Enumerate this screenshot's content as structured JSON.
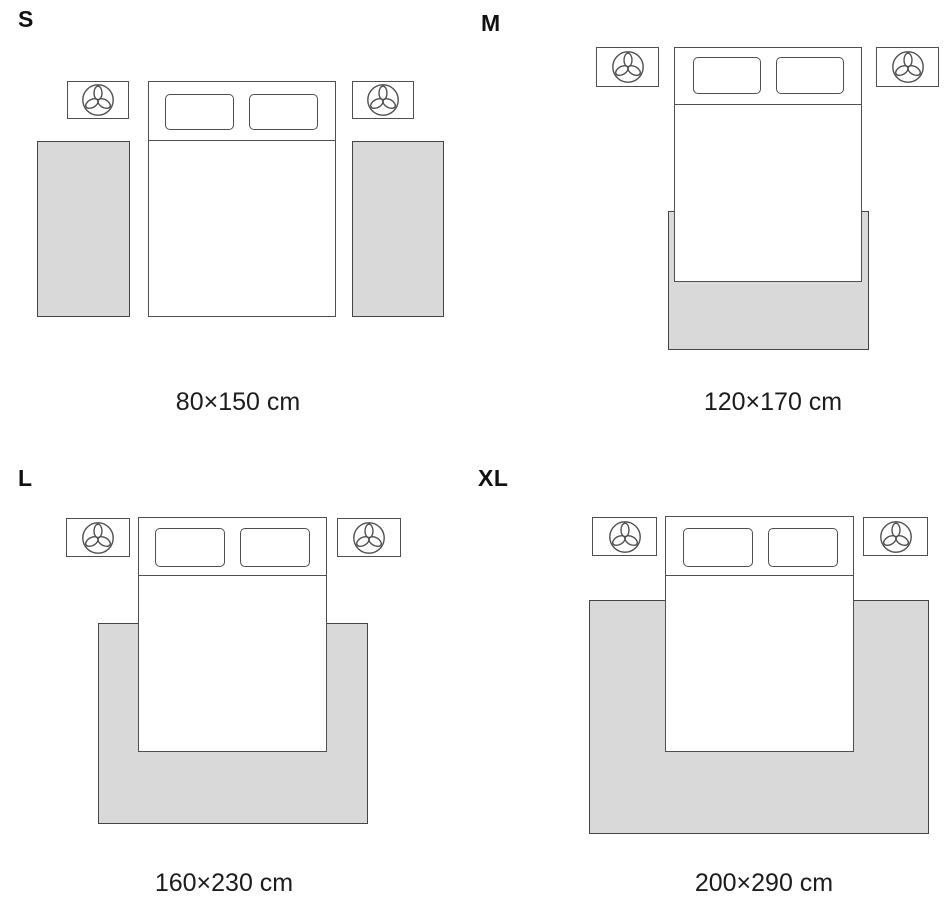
{
  "diagram_title": "",
  "colors": {
    "line": "#4f4f4f",
    "rug_fill": "#d9d9d9",
    "rug_line": "#444444",
    "text": "#1c1c1c",
    "label": "#111111",
    "background": "#ffffff"
  },
  "icons": {
    "nightstand_icon": "plant-trefoil-in-circle"
  },
  "panels": [
    {
      "id": "s",
      "label": "S",
      "caption": "80×150 cm",
      "rug_layout": "two bedside runner rugs flanking the bed",
      "rug_count": 2
    },
    {
      "id": "m",
      "label": "M",
      "caption": "120×170 cm",
      "rug_layout": "rug under lower part of bed, slight side overhang",
      "rug_count": 1
    },
    {
      "id": "l",
      "label": "L",
      "caption": "160×230 cm",
      "rug_layout": "large rug under lower two-thirds of bed extending on both sides",
      "rug_count": 1
    },
    {
      "id": "xl",
      "label": "XL",
      "caption": "200×290 cm",
      "rug_layout": "extra large rug under bed extending widely on both sides and below",
      "rug_count": 1
    }
  ]
}
